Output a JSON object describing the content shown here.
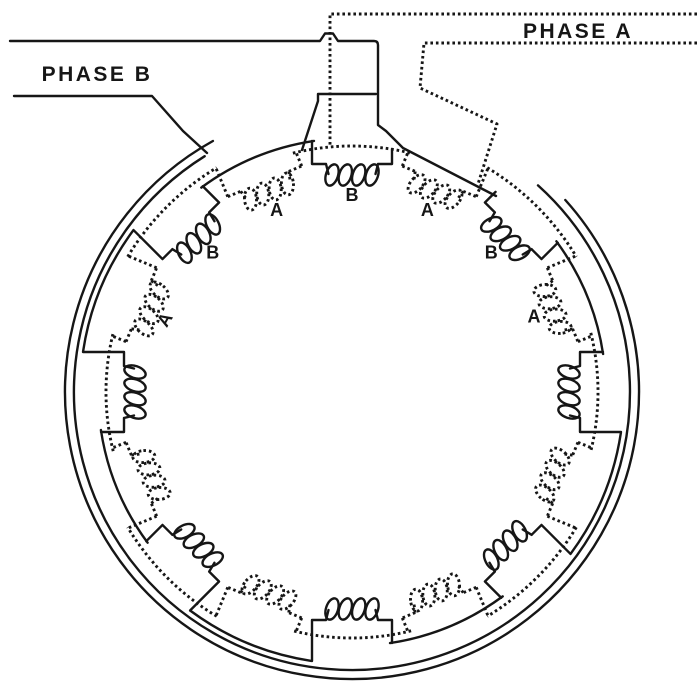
{
  "figure": {
    "background": "#ffffff",
    "ink": "#161616",
    "phases": {
      "a": {
        "label": "PHASE A",
        "line_style": "dotted"
      },
      "b": {
        "label": "PHASE B",
        "line_style": "solid"
      }
    },
    "pole_count": 16,
    "coil_sequence": [
      {
        "k": 0,
        "phase": "B"
      },
      {
        "k": 1,
        "phase": "A"
      },
      {
        "k": 2,
        "phase": "B"
      },
      {
        "k": 3,
        "phase": "A"
      },
      {
        "k": 4,
        "phase": "B"
      },
      {
        "k": 5,
        "phase": "A"
      },
      {
        "k": 6,
        "phase": "B"
      },
      {
        "k": 7,
        "phase": "A"
      },
      {
        "k": 8,
        "phase": "B"
      },
      {
        "k": 9,
        "phase": "A"
      },
      {
        "k": 10,
        "phase": "B"
      },
      {
        "k": 11,
        "phase": "A"
      },
      {
        "k": 12,
        "phase": "B"
      },
      {
        "k": 13,
        "phase": "A"
      },
      {
        "k": 14,
        "phase": "B"
      },
      {
        "k": 15,
        "phase": "A"
      }
    ],
    "coil_labels": [
      {
        "k": -3,
        "text": "A",
        "rotate": -60
      },
      {
        "k": -2,
        "text": "B",
        "rotate": 0
      },
      {
        "k": -1,
        "text": "A",
        "rotate": 0
      },
      {
        "k": 0,
        "text": "B",
        "rotate": 0
      },
      {
        "k": 1,
        "text": "A",
        "rotate": 0
      },
      {
        "k": 2,
        "text": "B",
        "rotate": 0
      },
      {
        "k": 3,
        "text": "A",
        "rotate": 0
      }
    ]
  }
}
